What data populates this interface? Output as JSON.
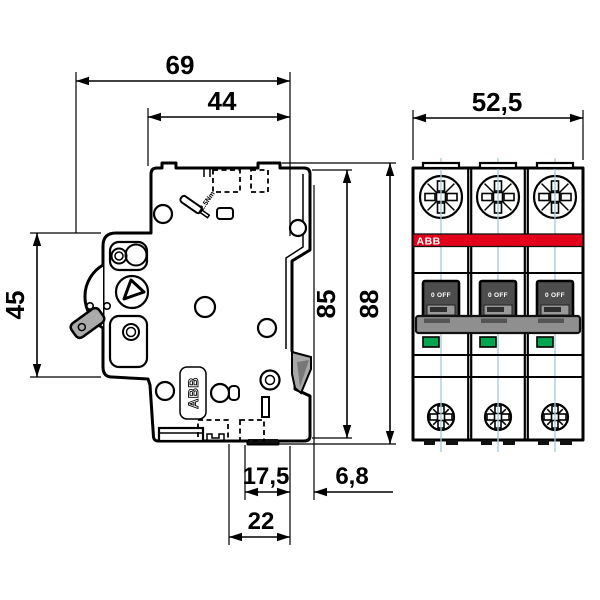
{
  "drawing": {
    "type": "technical-dimension-drawing",
    "subject": "ABB miniature circuit breaker, 3-pole: side view (left) and front view (right)",
    "units": "mm"
  },
  "dimensions": {
    "depth_total": "69",
    "depth_upper": "44",
    "width_front": "52,5",
    "height_front_section": "45",
    "height_body": "85",
    "height_total": "88",
    "din_recess_to_front": "17,5",
    "rear_depth": "6,8",
    "din_slot_width": "22"
  },
  "labels": {
    "torque": "2.5Nm",
    "brand_side_plate": "ABB"
  },
  "front": {
    "poles": 3,
    "brand": "ABB",
    "toggle_state": "0 OFF"
  },
  "colors": {
    "brand_red": "#E2001A",
    "indicator_green": "#00A650",
    "toggle_gray": "#4D4D4D",
    "tiebar_gray": "#8F8F8F",
    "lever_gray": "#ABABAB",
    "clip_gray": "#A8A8A8",
    "centerline_blue": "#A5C8DC"
  }
}
